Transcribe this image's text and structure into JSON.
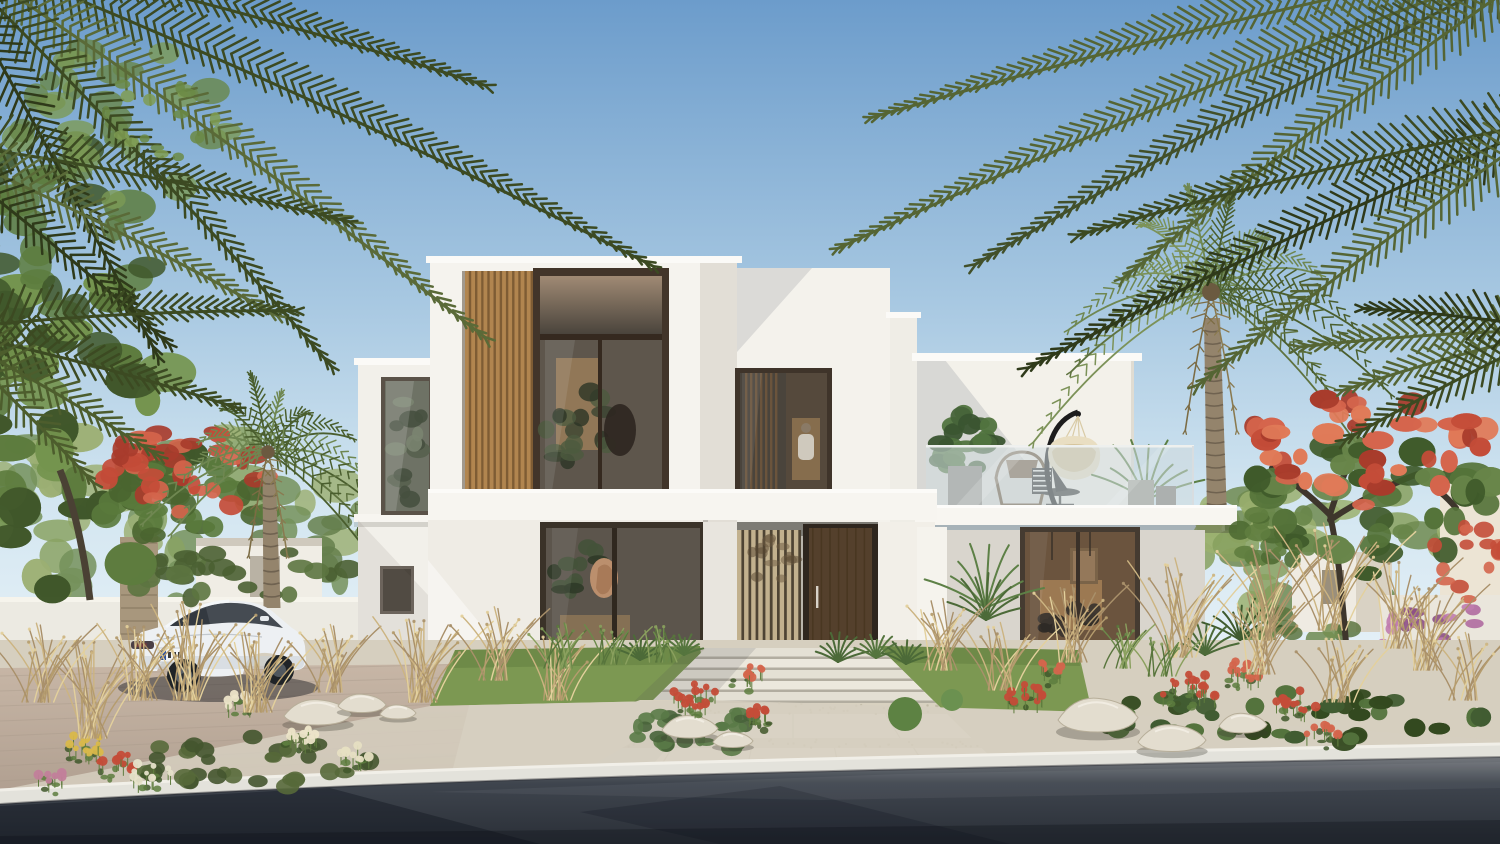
{
  "scene": {
    "title": "Modern two-storey white villa exterior rendering",
    "setting": "clear sunny day, desert-suburban residential community",
    "elements": {
      "sky": "clear blue sky, lighter toward horizon",
      "villa": "white cubic two-storey villa with vertical timber slat feature panels",
      "upper_window_main": "double-height bronze-framed window with warm interior",
      "upper_window_center": "framed window with interior timber slats",
      "balcony": "roof terrace with frameless glass balustrade",
      "balcony_items": "hanging egg chair, rattan chairs, monstera and areca palms in planters",
      "entrance": "recessed porch with timber slat screen and dark walnut pivot door",
      "ground_windows": "full-height glazing with warm lit interiors and artwork",
      "left_palm": "date palm beside driveway",
      "right_palm": "tall date palm beside terrace",
      "flame_trees": "red-flowering royal poinciana trees left and right",
      "corner_fronds": "dark palm fronds framing top corners",
      "garden": "ornamental dry grasses, red flower shrubs, boulders, lawn, gravel beds",
      "walkway": "light stone stepped walkway to entrance",
      "driveway": "paved driveway with parked white sedan",
      "car": "white electric sedan, rear three-quarter view, unreadable license plate",
      "road": "dark asphalt road with tree shadows in foreground",
      "neighborhood": "distant white villas, perimeter walls, stone pillar, bougainvillea"
    }
  },
  "palette": {
    "sky_top": "#6c9ccb",
    "sky_mid": "#a6c7e1",
    "sky_low": "#d3e6f1",
    "sky_horizon": "#eaf3f8",
    "wall_white": "#f5f3ee",
    "wall_lit": "#faf9f5",
    "wall_shade": "#e2ded6",
    "wall_gray": "#d8d4cc",
    "coping": "#fbfaf7",
    "recess": "#b9b5ac",
    "wood": "#b1854f",
    "wood_dark": "#7e5c34",
    "screen_slat": "#c2b18e",
    "screen_gap": "#4e4434",
    "frame_dark": "#42352a",
    "door": "#54402c",
    "glass_dark": "#4a443c",
    "glass_warm": "#8a7154",
    "glass_bronze": "#a08a74",
    "interior_glow": "#c49862",
    "railing_glass": "#c3d2d6",
    "monstera": "#47643a",
    "plant_green": "#5d8046",
    "cream": "#e9dec2",
    "ink": "#232323",
    "grass": "#7c9852",
    "grass_dark": "#5f7c3e",
    "dry1": "#ccb481",
    "dry2": "#b59c6e",
    "dry3": "#e3d09c",
    "leaf": "#5d7c3e",
    "leaf_dark": "#40572a",
    "leaf_light": "#74944e",
    "palm1": "#5f7340",
    "palm2": "#4a5e2e",
    "palm3": "#6f8751",
    "frond1": "#3c4a22",
    "frond2": "#2f3a1a",
    "frond3": "#4d5d2d",
    "frond4": "#5a6a38",
    "red1": "#c44c38",
    "red2": "#d4654c",
    "red3": "#a83c2c",
    "pink": "#b06aa0",
    "rock": "#e3ddcf",
    "rock_shade": "#b7ae99",
    "paver": "#e9e5da",
    "paver_shade": "#b2ada0",
    "gravel": "#d8d1c0",
    "sand": "#d6cfbf",
    "curb": "#e3e2db",
    "curb_lip": "#f1efe8",
    "road_top": "#83868a",
    "road_mid": "#3f454e",
    "road_low": "#2a2f37",
    "shadow_blue": "rgba(16,21,32,0.42)",
    "drive1": "#c7b6a6",
    "drive2": "#ae9d8e",
    "car_body": "#edf0f3",
    "car_shade": "#c9cfd6",
    "car_glass": "#454b52",
    "trunkA": "#94846c",
    "trunkB": "#6f6250",
    "stone": "#a8977d"
  }
}
